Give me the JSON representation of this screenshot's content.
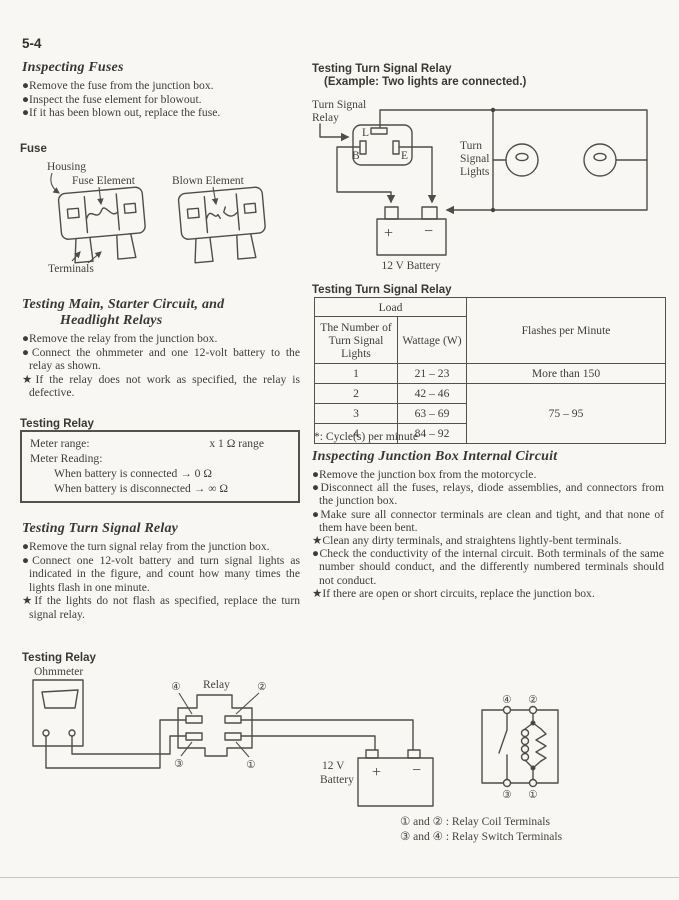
{
  "page": {
    "number": "5-4"
  },
  "appearance": {
    "paper": "#f8f7f4",
    "ink": "#403d38",
    "line": "#55524c"
  },
  "left": {
    "inspecting_fuses": {
      "heading": "Inspecting Fuses",
      "bullets": [
        {
          "mark": "●",
          "text": "Remove the fuse from the junction box."
        },
        {
          "mark": "●",
          "text": "Inspect the fuse element for blowout."
        },
        {
          "mark": "●",
          "text": "If it has been blown out, replace the fuse."
        }
      ]
    },
    "fuse_figure": {
      "title": "Fuse",
      "housing": "Housing",
      "fuse_element": "Fuse Element",
      "blown_element": "Blown Element",
      "terminals": "Terminals"
    },
    "testing_main": {
      "heading1": "Testing Main, Starter Circuit, and",
      "heading2": "Headlight Relays",
      "bullets": [
        {
          "mark": "●",
          "text": "Remove the relay from the junction box."
        },
        {
          "mark": "●",
          "text": "Connect the ohmmeter and one 12-volt battery to the relay as shown."
        },
        {
          "mark": "★",
          "text": "If the relay does not work as specified, the relay is defective."
        }
      ]
    },
    "testing_relay_spec": {
      "title": "Testing Relay",
      "meter_range_label": "Meter range:",
      "meter_range_value": "x 1 Ω range",
      "meter_reading_label": "Meter Reading:",
      "reading_connected": "When battery is connected → 0 Ω",
      "reading_disconnected": "When battery is disconnected → ∞ Ω"
    },
    "testing_turn_signal": {
      "heading": "Testing Turn Signal Relay",
      "bullets": [
        {
          "mark": "●",
          "text": "Remove the turn signal relay from the junction box."
        },
        {
          "mark": "●",
          "text": "Connect one 12-volt battery and turn signal lights as indicated in the figure, and count how many times the lights flash in one minute."
        },
        {
          "mark": "★",
          "text": "If the lights do not flash as specified, replace the turn signal relay."
        }
      ]
    }
  },
  "right": {
    "circuit_figure": {
      "title": "Testing Turn Signal Relay",
      "subtitle": "(Example: Two lights are connected.)",
      "relay_label1": "Turn Signal",
      "relay_label2": "Relay",
      "terminal_l": "L",
      "terminal_b": "B",
      "terminal_e": "E",
      "lights_label1": "Turn",
      "lights_label2": "Signal",
      "lights_label3": "Lights",
      "plus": "+",
      "minus": "−",
      "battery_label": "12 V Battery"
    },
    "flash_table": {
      "title": "Testing Turn Signal Relay",
      "header_load": "Load",
      "header_lights": "The Number of Turn Signal Lights",
      "header_wattage": "Wattage (W)",
      "header_flashes": "Flashes per Minute",
      "rows": [
        {
          "lights": "1",
          "wattage": "21 – 23"
        },
        {
          "lights": "2",
          "wattage": "42 – 46"
        },
        {
          "lights": "3",
          "wattage": "63 – 69"
        },
        {
          "lights": "4",
          "wattage": "84 – 92"
        }
      ],
      "flashes_row1": "More than 150",
      "flashes_rows2to4": "75 – 95",
      "footnote": "*: Cycle(s) per minute"
    },
    "junction_box": {
      "heading": "Inspecting Junction Box Internal Circuit",
      "bullets": [
        {
          "mark": "●",
          "text": "Remove the junction box from the motorcycle."
        },
        {
          "mark": "●",
          "text": "Disconnect all the fuses, relays, diode assemblies, and connectors from the junction box."
        },
        {
          "mark": "●",
          "text": "Make sure all connector terminals are clean and tight, and that none of them have been bent."
        },
        {
          "mark": "★",
          "text": "Clean any dirty terminals, and straightens lightly-bent terminals."
        },
        {
          "mark": "●",
          "text": "Check the conductivity of the internal circuit.  Both terminals of the same number should conduct, and the differently numbered terminals should not conduct."
        },
        {
          "mark": "★",
          "text": "If there are open or short circuits, replace the junction box."
        }
      ]
    }
  },
  "bottom_figure": {
    "title": "Testing Relay",
    "ohmmeter_label": "Ohmmeter",
    "relay_label": "Relay",
    "t1": "①",
    "t2": "②",
    "t3": "③",
    "t4": "④",
    "plus": "+",
    "minus": "−",
    "battery_label1": "12 V",
    "battery_label2": "Battery",
    "legend_coil": "① and ② :  Relay Coil Terminals",
    "legend_switch": "③ and ④ :  Relay Switch Terminals"
  }
}
